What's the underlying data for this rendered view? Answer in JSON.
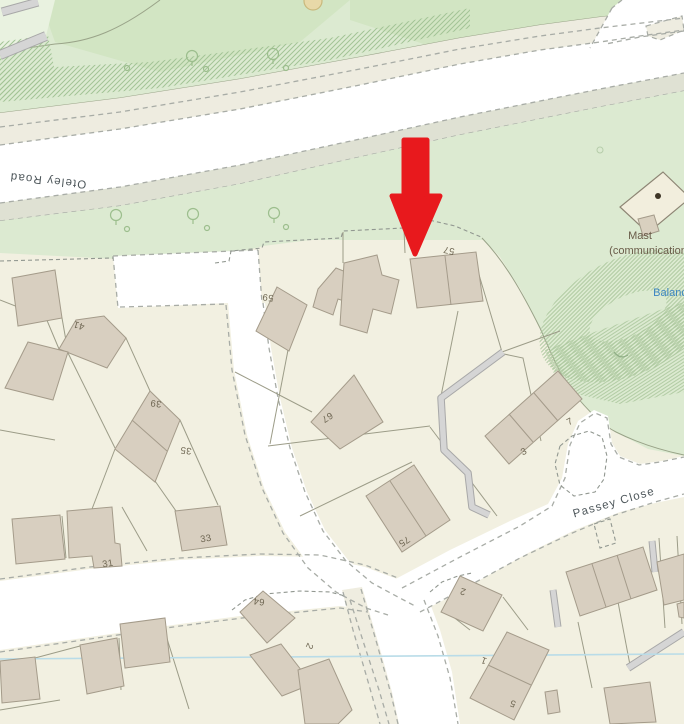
{
  "map": {
    "description": "Ordnance-Survey-style residential street map with red arrow marker",
    "marker": {
      "shape": "red-arrow-down",
      "color": "#e8191d",
      "points_at_house": "57"
    },
    "street_labels": [
      {
        "text": "Oteley Road",
        "x": 48,
        "y": 180,
        "rotate": 186,
        "size": 11.5,
        "color": "#4d565a"
      },
      {
        "text": "Passey Close",
        "x": 614,
        "y": 503,
        "rotate": -16,
        "size": 11.5,
        "color": "#4d565a"
      }
    ],
    "poi_labels": [
      {
        "text": "Mast",
        "x": 640,
        "y": 236,
        "rotate": 0,
        "size": 11,
        "color": "#695b48"
      },
      {
        "text": "(communication",
        "x": 648,
        "y": 251,
        "rotate": 0,
        "size": 11,
        "color": "#695b48"
      },
      {
        "text": "Balanc",
        "x": 670,
        "y": 293,
        "rotate": 0,
        "size": 11,
        "color": "#3d86c2"
      }
    ],
    "house_numbers": [
      {
        "text": "59",
        "x": 268,
        "y": 297,
        "rotate": 187
      },
      {
        "text": "57",
        "x": 449,
        "y": 250,
        "rotate": 192
      },
      {
        "text": "41",
        "x": 79,
        "y": 325,
        "rotate": 197
      },
      {
        "text": "39",
        "x": 156,
        "y": 403,
        "rotate": 187
      },
      {
        "text": "35",
        "x": 186,
        "y": 450,
        "rotate": 187
      },
      {
        "text": "33",
        "x": 206,
        "y": 539,
        "rotate": -10
      },
      {
        "text": "31",
        "x": 108,
        "y": 564,
        "rotate": -10
      },
      {
        "text": "67",
        "x": 327,
        "y": 417,
        "rotate": 148
      },
      {
        "text": "75",
        "x": 404,
        "y": 541,
        "rotate": 148
      },
      {
        "text": "3",
        "x": 524,
        "y": 452,
        "rotate": -28
      },
      {
        "text": "7",
        "x": 570,
        "y": 422,
        "rotate": -28
      },
      {
        "text": "64",
        "x": 259,
        "y": 601,
        "rotate": 187
      },
      {
        "text": "2",
        "x": 309,
        "y": 646,
        "rotate": 115
      },
      {
        "text": "2",
        "x": 463,
        "y": 591,
        "rotate": 195
      },
      {
        "text": "1",
        "x": 484,
        "y": 660,
        "rotate": 200
      },
      {
        "text": "5",
        "x": 513,
        "y": 703,
        "rotate": 200
      }
    ],
    "colors": {
      "park": "#dcead1",
      "park_dark": "#d2e5c3",
      "park_light": "#e9f2e0",
      "parcel": "#f2f0e1",
      "road": "#ffffff",
      "footway_beige": "#eeece0",
      "verge": "#dfe1d3",
      "building": "#d8cfc0",
      "building_stroke": "#a49b8a",
      "hatch": "#a3c496",
      "casing_dash": "#a8aca6",
      "parcel_line": "#9c9c88",
      "boundary": "#98a287",
      "stream": "#b9dce8",
      "gray_path": "#d5d5d5",
      "housenumber_text": "#6f6753",
      "street_text": "#4d565a",
      "mast_text": "#695b48",
      "pond_text": "#3d86c2",
      "arrow": "#e8191d"
    }
  }
}
